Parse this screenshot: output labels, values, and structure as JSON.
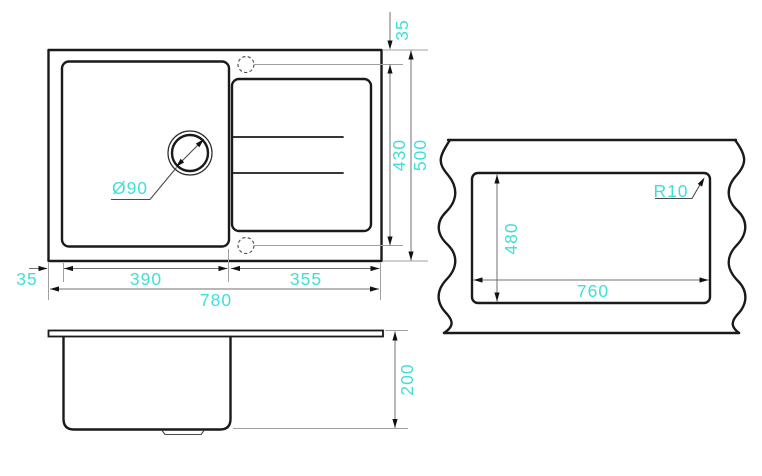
{
  "drawing": {
    "type": "technical-dimension-drawing",
    "subject": "kitchen sink with drainboard",
    "colors": {
      "dimension_text": "#3FDFD8",
      "object_lines": "#1a1a1a",
      "dimension_lines": "#707070",
      "extension_lines": "#a0a0a0",
      "background": "#ffffff"
    },
    "top_view": {
      "labels": {
        "top_rim_offset": "35",
        "inner_height": "430",
        "overall_height": "500",
        "left_rim_offset": "35",
        "bowl_width": "390",
        "drainboard_width": "355",
        "overall_width": "780",
        "drain_diameter": "Ø90"
      }
    },
    "side_view": {
      "labels": {
        "bowl_depth": "200"
      }
    },
    "cutout_view": {
      "labels": {
        "cutout_height": "480",
        "cutout_width": "760",
        "corner_radius": "R10"
      }
    }
  }
}
